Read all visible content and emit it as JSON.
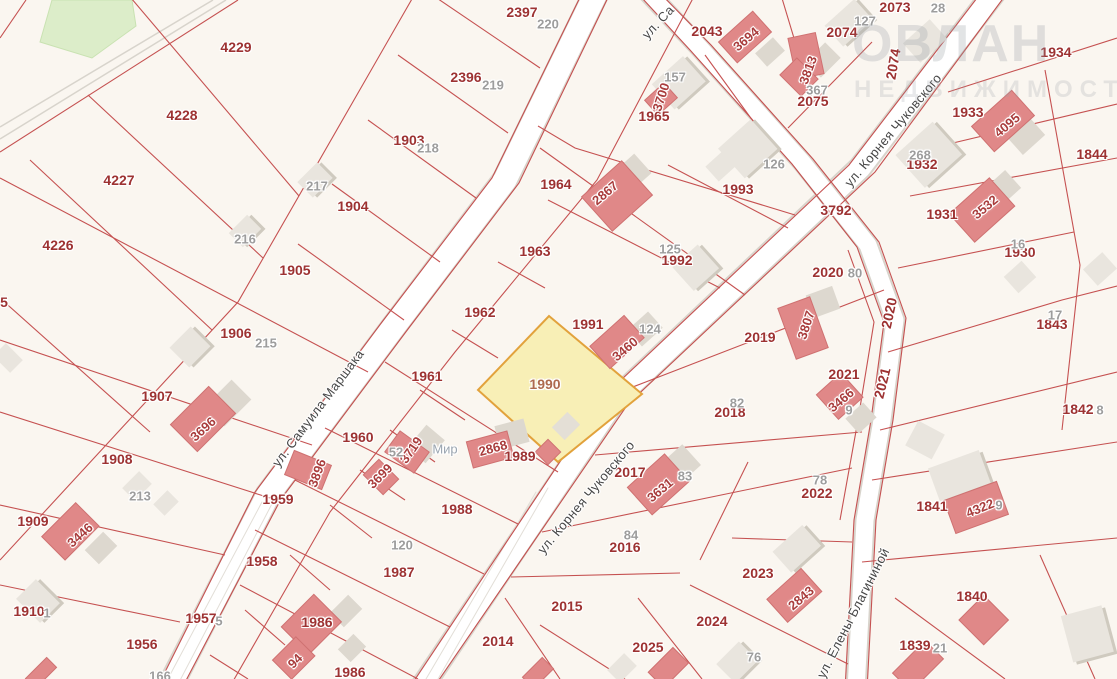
{
  "map": {
    "type": "cadastral-map",
    "highlighted_parcel": {
      "number": "1990",
      "fill_color": "#f8efb6",
      "border_color": "#e2a23c"
    },
    "streets": [
      "ул. Самуила Маршака",
      "ул. Корнея Чуковского",
      "ул. Елены Благининой"
    ],
    "watermark": {
      "line1": "ОВЛАН",
      "line2": "НЕДВИЖИМОСТЬ"
    },
    "colors": {
      "background": "#faf6f0",
      "parcel_line": "#c34949",
      "parcel_label": "#9d3232",
      "building_fill_red": "#e08888",
      "building_fill_gray": "#e9e5de",
      "road_fill": "#ffffff",
      "green_area": "#dcedc9"
    },
    "labels": [
      {
        "t": "4229",
        "x": 236,
        "y": 47,
        "c": "p"
      },
      {
        "t": "4228",
        "x": 182,
        "y": 115,
        "c": "p"
      },
      {
        "t": "4227",
        "x": 119,
        "y": 180,
        "c": "p"
      },
      {
        "t": "4226",
        "x": 58,
        "y": 245,
        "c": "p"
      },
      {
        "t": "2397",
        "x": 522,
        "y": 12,
        "c": "p"
      },
      {
        "t": "2396",
        "x": 466,
        "y": 77,
        "c": "p"
      },
      {
        "t": "1903",
        "x": 409,
        "y": 140,
        "c": "p"
      },
      {
        "t": "1904",
        "x": 353,
        "y": 206,
        "c": "p"
      },
      {
        "t": "1905",
        "x": 295,
        "y": 270,
        "c": "p"
      },
      {
        "t": "1906",
        "x": 236,
        "y": 333,
        "c": "p"
      },
      {
        "t": "1907",
        "x": 157,
        "y": 396,
        "c": "p"
      },
      {
        "t": "1908",
        "x": 117,
        "y": 459,
        "c": "p"
      },
      {
        "t": "1909",
        "x": 33,
        "y": 521,
        "c": "p"
      },
      {
        "t": "1910",
        "x": 29,
        "y": 611,
        "c": "p"
      },
      {
        "t": "5",
        "x": 4,
        "y": 302,
        "c": "p"
      },
      {
        "t": "1956",
        "x": 142,
        "y": 644,
        "c": "p"
      },
      {
        "t": "1957",
        "x": 201,
        "y": 618,
        "c": "p"
      },
      {
        "t": "1958",
        "x": 262,
        "y": 561,
        "c": "p"
      },
      {
        "t": "1959",
        "x": 278,
        "y": 499,
        "c": "p"
      },
      {
        "t": "1960",
        "x": 358,
        "y": 437,
        "c": "p"
      },
      {
        "t": "1961",
        "x": 427,
        "y": 376,
        "c": "p"
      },
      {
        "t": "1962",
        "x": 480,
        "y": 312,
        "c": "p"
      },
      {
        "t": "1963",
        "x": 535,
        "y": 251,
        "c": "p"
      },
      {
        "t": "1964",
        "x": 556,
        "y": 184,
        "c": "p"
      },
      {
        "t": "1965",
        "x": 654,
        "y": 116,
        "c": "p"
      },
      {
        "t": "2043",
        "x": 707,
        "y": 31,
        "c": "p"
      },
      {
        "t": "2073",
        "x": 895,
        "y": 7,
        "c": "p"
      },
      {
        "t": "2074",
        "x": 842,
        "y": 32,
        "c": "p"
      },
      {
        "t": "2074",
        "x": 893,
        "y": 64,
        "r": -80,
        "c": "p"
      },
      {
        "t": "2075",
        "x": 813,
        "y": 101,
        "c": "p"
      },
      {
        "t": "1993",
        "x": 738,
        "y": 189,
        "c": "p"
      },
      {
        "t": "1992",
        "x": 677,
        "y": 260,
        "c": "p"
      },
      {
        "t": "1991",
        "x": 588,
        "y": 324,
        "c": "p"
      },
      {
        "t": "1989",
        "x": 520,
        "y": 456,
        "c": "p"
      },
      {
        "t": "1988",
        "x": 457,
        "y": 509,
        "c": "p"
      },
      {
        "t": "1987",
        "x": 399,
        "y": 572,
        "c": "p"
      },
      {
        "t": "1986",
        "x": 317,
        "y": 622,
        "c": "p"
      },
      {
        "t": "1986",
        "x": 350,
        "y": 672,
        "c": "p"
      },
      {
        "t": "2014",
        "x": 498,
        "y": 641,
        "c": "p"
      },
      {
        "t": "2015",
        "x": 567,
        "y": 606,
        "c": "p"
      },
      {
        "t": "2016",
        "x": 625,
        "y": 547,
        "c": "p"
      },
      {
        "t": "2017",
        "x": 630,
        "y": 472,
        "c": "p"
      },
      {
        "t": "2018",
        "x": 730,
        "y": 412,
        "c": "p"
      },
      {
        "t": "2019",
        "x": 760,
        "y": 337,
        "c": "p"
      },
      {
        "t": "2020",
        "x": 828,
        "y": 272,
        "c": "p"
      },
      {
        "t": "2020",
        "x": 889,
        "y": 313,
        "r": -78,
        "c": "p"
      },
      {
        "t": "2021",
        "x": 844,
        "y": 374,
        "c": "p"
      },
      {
        "t": "2021",
        "x": 882,
        "y": 383,
        "r": -76,
        "c": "p"
      },
      {
        "t": "2022",
        "x": 817,
        "y": 493,
        "c": "p"
      },
      {
        "t": "2023",
        "x": 758,
        "y": 573,
        "c": "p"
      },
      {
        "t": "2024",
        "x": 712,
        "y": 621,
        "c": "p"
      },
      {
        "t": "2025",
        "x": 648,
        "y": 647,
        "c": "p"
      },
      {
        "t": "3792",
        "x": 836,
        "y": 210,
        "c": "p"
      },
      {
        "t": "1934",
        "x": 1056,
        "y": 52,
        "c": "p"
      },
      {
        "t": "1933",
        "x": 968,
        "y": 112,
        "c": "p"
      },
      {
        "t": "1932",
        "x": 922,
        "y": 164,
        "c": "p"
      },
      {
        "t": "1931",
        "x": 942,
        "y": 214,
        "c": "p"
      },
      {
        "t": "1930",
        "x": 1020,
        "y": 252,
        "c": "p"
      },
      {
        "t": "1844",
        "x": 1092,
        "y": 154,
        "c": "p"
      },
      {
        "t": "1843",
        "x": 1052,
        "y": 324,
        "c": "p"
      },
      {
        "t": "1842",
        "x": 1078,
        "y": 409,
        "c": "p"
      },
      {
        "t": "1841",
        "x": 932,
        "y": 506,
        "c": "p"
      },
      {
        "t": "1840",
        "x": 972,
        "y": 596,
        "c": "p"
      },
      {
        "t": "1839",
        "x": 915,
        "y": 645,
        "c": "p"
      },
      {
        "t": "3696",
        "x": 203,
        "y": 429,
        "r": -42,
        "c": "b"
      },
      {
        "t": "3446",
        "x": 80,
        "y": 535,
        "r": -42,
        "c": "b"
      },
      {
        "t": "3896",
        "x": 317,
        "y": 473,
        "r": -70,
        "c": "b"
      },
      {
        "t": "3719",
        "x": 411,
        "y": 450,
        "r": -55,
        "c": "b"
      },
      {
        "t": "3699",
        "x": 380,
        "y": 476,
        "r": -45,
        "c": "b"
      },
      {
        "t": "2868",
        "x": 493,
        "y": 448,
        "r": -15,
        "c": "b"
      },
      {
        "t": "3460",
        "x": 625,
        "y": 349,
        "r": -40,
        "c": "b"
      },
      {
        "t": "2867",
        "x": 605,
        "y": 193,
        "r": -40,
        "c": "b"
      },
      {
        "t": "3700",
        "x": 661,
        "y": 97,
        "r": -72,
        "c": "b"
      },
      {
        "t": "3694",
        "x": 746,
        "y": 39,
        "r": -40,
        "c": "b"
      },
      {
        "t": "3813",
        "x": 808,
        "y": 70,
        "r": -70,
        "c": "b"
      },
      {
        "t": "4095",
        "x": 1007,
        "y": 125,
        "r": -40,
        "c": "b"
      },
      {
        "t": "3532",
        "x": 985,
        "y": 207,
        "r": -40,
        "c": "b"
      },
      {
        "t": "3807",
        "x": 806,
        "y": 325,
        "r": -72,
        "c": "b"
      },
      {
        "t": "3466",
        "x": 841,
        "y": 400,
        "r": -40,
        "c": "b"
      },
      {
        "t": "3631",
        "x": 660,
        "y": 490,
        "r": -40,
        "c": "b"
      },
      {
        "t": "2843",
        "x": 801,
        "y": 598,
        "r": -40,
        "c": "b"
      },
      {
        "t": "4322",
        "x": 980,
        "y": 508,
        "r": -22,
        "c": "b"
      },
      {
        "t": "94",
        "x": 295,
        "y": 661,
        "r": -45,
        "c": "b"
      },
      {
        "t": "220",
        "x": 548,
        "y": 24,
        "c": "g"
      },
      {
        "t": "219",
        "x": 493,
        "y": 85,
        "c": "g"
      },
      {
        "t": "218",
        "x": 428,
        "y": 148,
        "c": "g"
      },
      {
        "t": "217",
        "x": 317,
        "y": 186,
        "c": "g"
      },
      {
        "t": "216",
        "x": 245,
        "y": 239,
        "c": "g"
      },
      {
        "t": "215",
        "x": 266,
        "y": 343,
        "c": "g"
      },
      {
        "t": "213",
        "x": 140,
        "y": 496,
        "c": "g"
      },
      {
        "t": "1",
        "x": 47,
        "y": 613,
        "c": "g"
      },
      {
        "t": "5",
        "x": 219,
        "y": 621,
        "c": "g"
      },
      {
        "t": "166",
        "x": 160,
        "y": 676,
        "c": "g"
      },
      {
        "t": "157",
        "x": 675,
        "y": 77,
        "c": "g"
      },
      {
        "t": "127",
        "x": 865,
        "y": 21,
        "c": "g"
      },
      {
        "t": "28",
        "x": 938,
        "y": 8,
        "c": "g"
      },
      {
        "t": "367",
        "x": 817,
        "y": 90,
        "c": "g"
      },
      {
        "t": "126",
        "x": 774,
        "y": 164,
        "c": "g"
      },
      {
        "t": "125",
        "x": 670,
        "y": 249,
        "c": "g"
      },
      {
        "t": "124",
        "x": 650,
        "y": 329,
        "c": "g"
      },
      {
        "t": "268",
        "x": 920,
        "y": 155,
        "c": "g"
      },
      {
        "t": "16",
        "x": 1018,
        "y": 244,
        "c": "g"
      },
      {
        "t": "17",
        "x": 1055,
        "y": 315,
        "c": "g"
      },
      {
        "t": "8",
        "x": 1100,
        "y": 410,
        "c": "g"
      },
      {
        "t": "80",
        "x": 855,
        "y": 273,
        "c": "g"
      },
      {
        "t": "82",
        "x": 737,
        "y": 403,
        "c": "g"
      },
      {
        "t": "83",
        "x": 685,
        "y": 476,
        "c": "g"
      },
      {
        "t": "84",
        "x": 631,
        "y": 535,
        "c": "g"
      },
      {
        "t": "78",
        "x": 820,
        "y": 480,
        "c": "g"
      },
      {
        "t": "120",
        "x": 402,
        "y": 545,
        "c": "g"
      },
      {
        "t": "52",
        "x": 396,
        "y": 452,
        "c": "g"
      },
      {
        "t": "76",
        "x": 754,
        "y": 657,
        "c": "g"
      },
      {
        "t": "9",
        "x": 849,
        "y": 410,
        "c": "g"
      },
      {
        "t": "9",
        "x": 999,
        "y": 505,
        "c": "g"
      },
      {
        "t": "21",
        "x": 940,
        "y": 648,
        "c": "g"
      },
      {
        "t": "1990",
        "x": 545,
        "y": 384,
        "c": "y"
      },
      {
        "t": "ул. Самуила Маршака",
        "x": 318,
        "y": 408,
        "r": -53,
        "c": "s"
      },
      {
        "t": "ул. Са",
        "x": 658,
        "y": 22,
        "r": -47,
        "c": "s"
      },
      {
        "t": "ул. Корнея Чуковского",
        "x": 893,
        "y": 130,
        "r": -50,
        "c": "s"
      },
      {
        "t": "ул. Корнея Чуковского",
        "x": 586,
        "y": 497,
        "r": -50,
        "c": "s"
      },
      {
        "t": "ул. Елены Благининой",
        "x": 853,
        "y": 613,
        "r": -63,
        "c": "s"
      },
      {
        "t": "Мир",
        "x": 445,
        "y": 449,
        "c": "loc"
      }
    ]
  }
}
